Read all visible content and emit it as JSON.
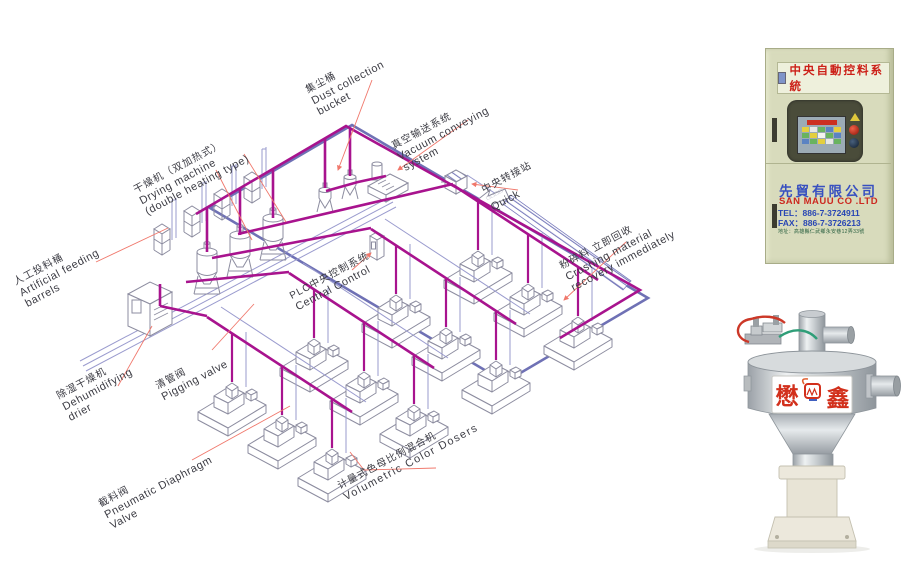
{
  "diagram": {
    "labels": [
      {
        "zh": "人工投料桶",
        "en1": "Artificial feeding",
        "en2": "barrels"
      },
      {
        "zh": "除湿干燥机",
        "en1": "Dehumidifying",
        "en2": "drier"
      },
      {
        "zh": "干燥机（双加热式）",
        "en1": "Drying machine",
        "en2": "(double heating type)"
      },
      {
        "zh": "集尘桶",
        "en1": "Dust collection",
        "en2": "bucket"
      },
      {
        "zh": "真空输送系统",
        "en1": "Vacuum conveying",
        "en2": "system"
      },
      {
        "zh": "中央转接站",
        "mid": "□□□□",
        "en1": "Quick",
        "en2": ""
      },
      {
        "zh": "粉碎料 立即回收",
        "en1": "Crushing material",
        "en2": "recovery immediately"
      },
      {
        "zh": "PLC中央控制系统",
        "en1": "Central Control",
        "en2": ""
      },
      {
        "zh": "清管阀",
        "en1": "Pigging valve",
        "en2": ""
      },
      {
        "zh": "截料阀",
        "en1": "Pneumatic Diaphragm",
        "en2": "Valve"
      },
      {
        "zh": "计量式色母比例混合机",
        "en1": "Volumetric Color Dosers",
        "en2": ""
      }
    ],
    "colors": {
      "pipe_magenta": "#a8138e",
      "pipe_purple": "#6f71b5",
      "pipe_thin_blue": "#9a9bce",
      "leader_red": "#f0776b",
      "machine_outline": "#8d8da0"
    }
  },
  "control_panel": {
    "banner": "中央自動控料系統",
    "company_zh": "先貿有限公司",
    "company_en": "SAN MAUU CO .LTD",
    "tel": "TEL：886-7-3724911",
    "fax": "FAX：886-7-3726213",
    "address": "地址：高雄縣仁武鄉永安巷12弄33號"
  },
  "hopper_label": {
    "char_left": "懋",
    "char_right": "鑫"
  }
}
